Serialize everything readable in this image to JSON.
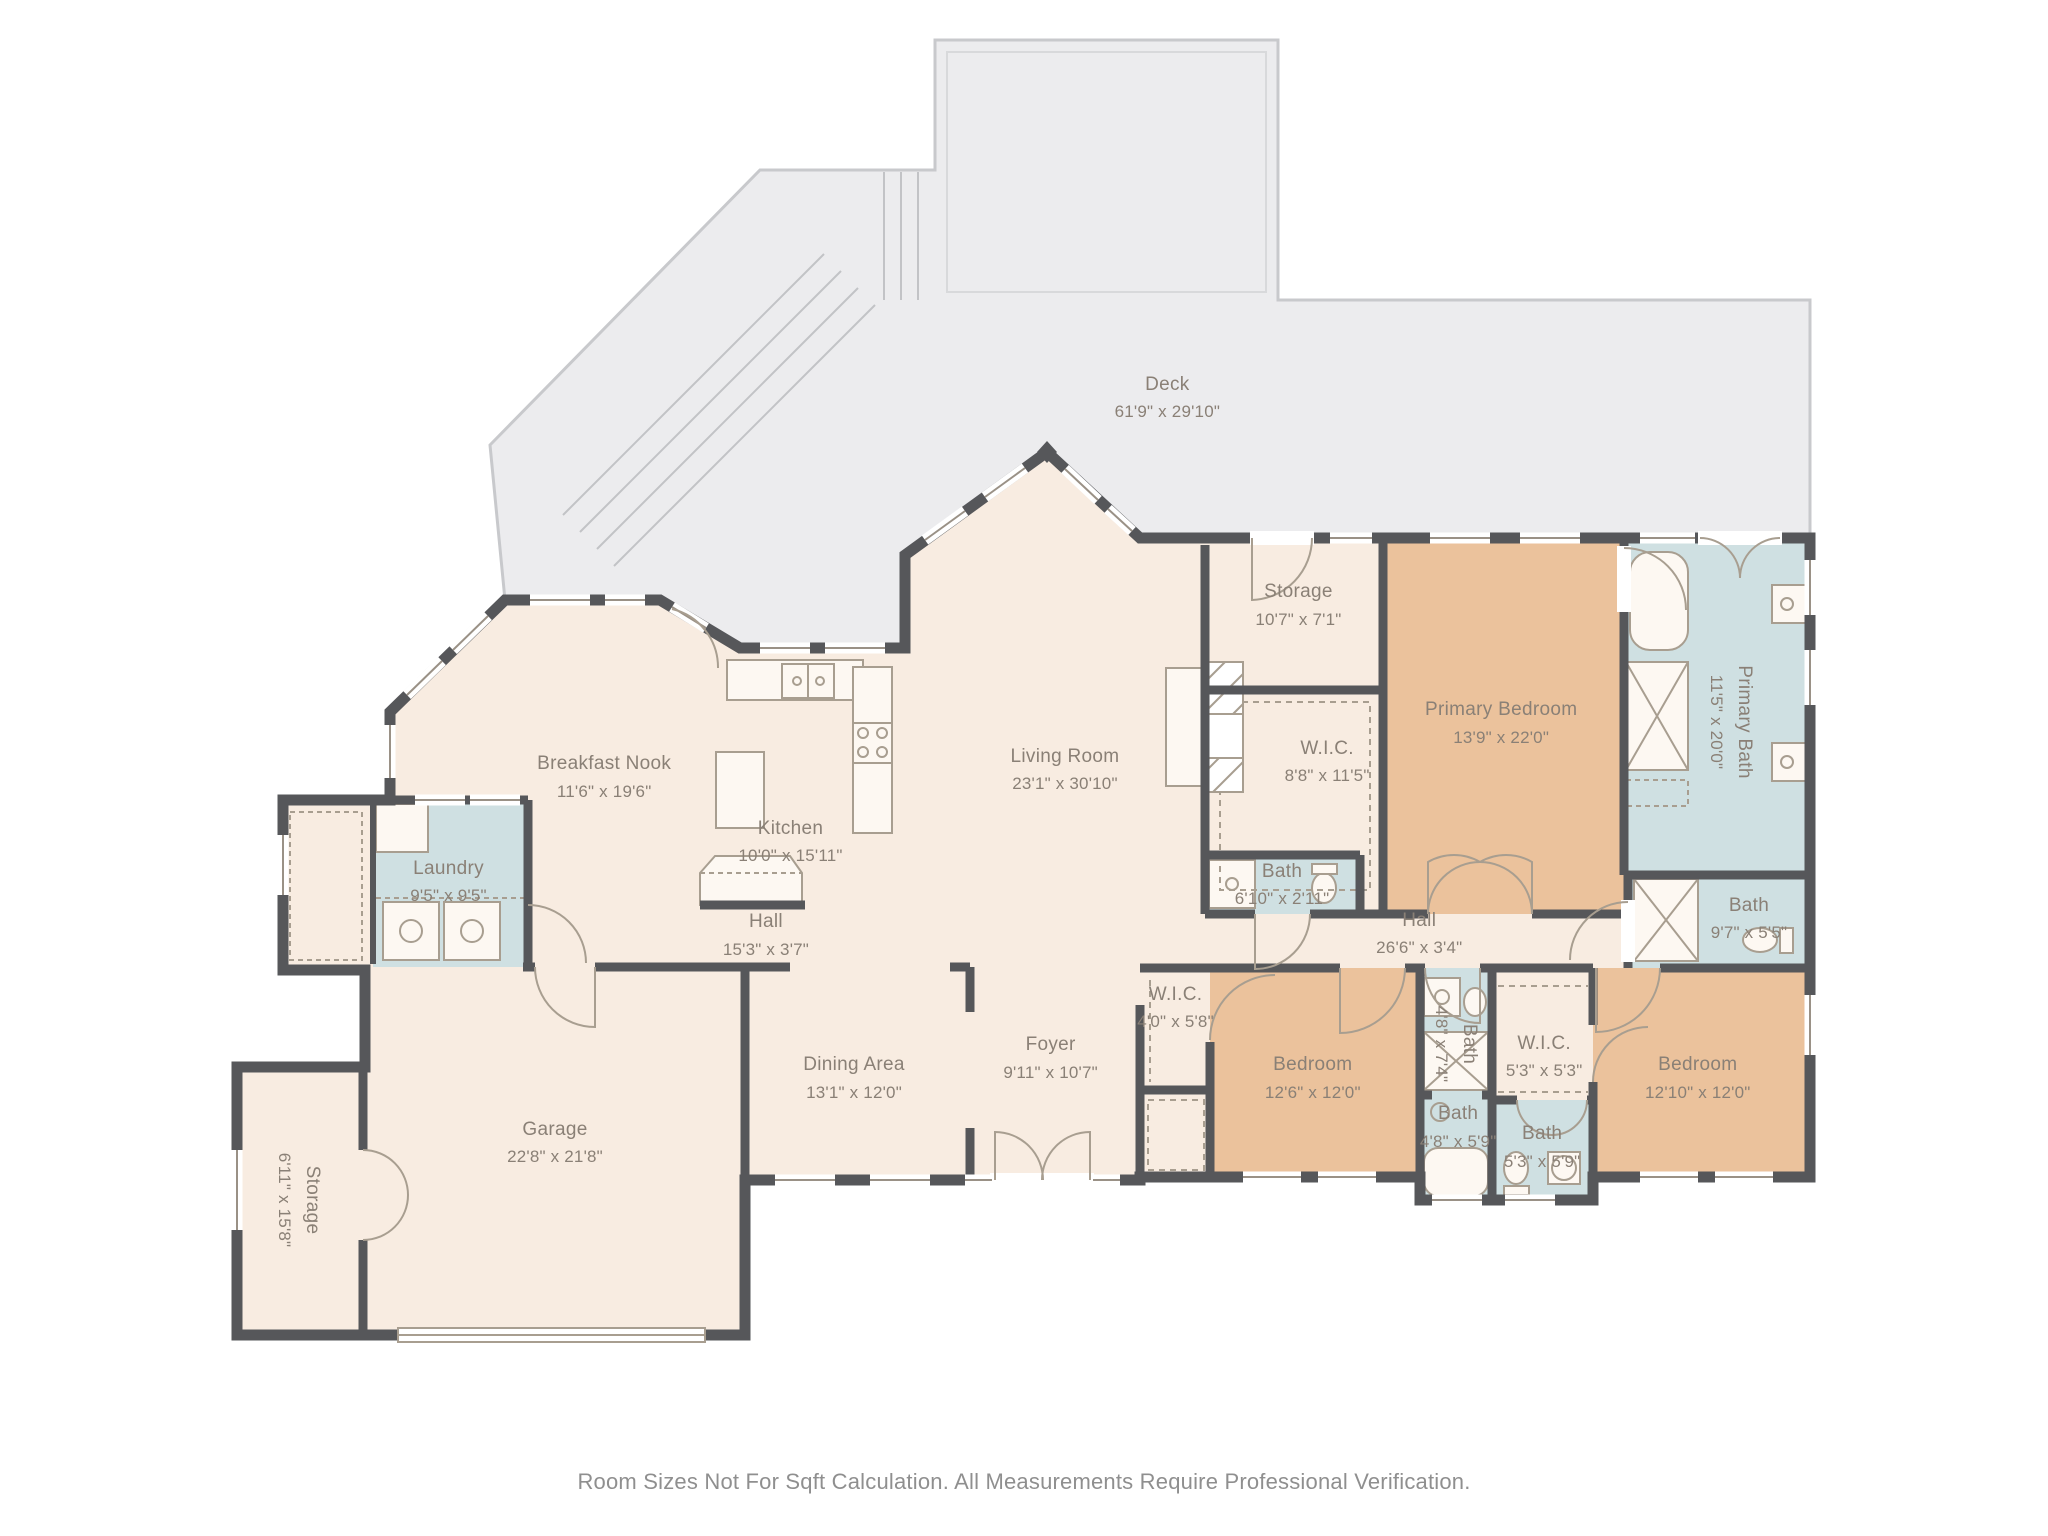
{
  "palette": {
    "floor": "#f8ece1",
    "bedroom_fill": "#ebc29c",
    "bath_fill": "#cfe0e2",
    "deck_fill": "#ececee",
    "deck_border": "#c8c9cc",
    "wall": "#56575a",
    "fixture_line": "#a89e90",
    "label_text": "#8a8076",
    "footer_text": "#8f8f8f"
  },
  "footer": {
    "disclaimer": "Room Sizes Not For Sqft Calculation. All Measurements Require Professional Verification."
  },
  "rooms": [
    {
      "id": "deck",
      "name": "Deck",
      "dims": "61'9\" x 29'10\"",
      "x": 57.0,
      "y": 25.9,
      "vert": false
    },
    {
      "id": "storage-top",
      "name": "Storage",
      "dims": "10'7\" x 7'1\"",
      "x": 63.4,
      "y": 39.4,
      "vert": false
    },
    {
      "id": "primary-bedroom",
      "name": "Primary Bedroom",
      "dims": "13'9\" x 22'0\"",
      "x": 73.3,
      "y": 47.1,
      "vert": false
    },
    {
      "id": "primary-bath",
      "name": "Primary Bath",
      "dims": "11'5\" x 20'0\"",
      "x": 84.5,
      "y": 47.0,
      "vert": true
    },
    {
      "id": "wic-primary",
      "name": "W.I.C.",
      "dims": "8'8\" x 11'5\"",
      "x": 64.8,
      "y": 49.6,
      "vert": false
    },
    {
      "id": "living-room",
      "name": "Living Room",
      "dims": "23'1\" x 30'10\"",
      "x": 52.0,
      "y": 50.1,
      "vert": false
    },
    {
      "id": "breakfast-nook",
      "name": "Breakfast Nook",
      "dims": "11'6\" x 19'6\"",
      "x": 29.5,
      "y": 50.6,
      "vert": false
    },
    {
      "id": "kitchen",
      "name": "Kitchen",
      "dims": "10'0\" x 15'11\"",
      "x": 38.6,
      "y": 54.8,
      "vert": false
    },
    {
      "id": "laundry",
      "name": "Laundry",
      "dims": "9'5\" x 9'5\"",
      "x": 21.9,
      "y": 57.4,
      "vert": false
    },
    {
      "id": "bath-610",
      "name": "Bath",
      "dims": "6'10\" x 2'11\"",
      "x": 62.6,
      "y": 57.6,
      "vert": false
    },
    {
      "id": "hall-west",
      "name": "Hall",
      "dims": "15'3\" x 3'7\"",
      "x": 37.4,
      "y": 60.9,
      "vert": false
    },
    {
      "id": "hall-east",
      "name": "Hall",
      "dims": "26'6\" x 3'4\"",
      "x": 69.3,
      "y": 60.8,
      "vert": false
    },
    {
      "id": "bath-97",
      "name": "Bath",
      "dims": "9'7\" x 5'5\"",
      "x": 85.4,
      "y": 59.8,
      "vert": false
    },
    {
      "id": "wic-40",
      "name": "W.I.C.",
      "dims": "4'0\" x 5'8\"",
      "x": 57.4,
      "y": 65.6,
      "vert": false
    },
    {
      "id": "bedroom-1",
      "name": "Bedroom",
      "dims": "12'6\" x 12'0\"",
      "x": 64.1,
      "y": 70.2,
      "vert": false
    },
    {
      "id": "bath-48a",
      "name": "Bath",
      "dims": "4'8\" x 7'4\"",
      "x": 71.1,
      "y": 68.0,
      "vert": true
    },
    {
      "id": "wic-53",
      "name": "W.I.C.",
      "dims": "5'3\" x 5'3\"",
      "x": 75.4,
      "y": 68.8,
      "vert": false
    },
    {
      "id": "bedroom-2",
      "name": "Bedroom",
      "dims": "12'10\" x 12'0\"",
      "x": 82.9,
      "y": 70.2,
      "vert": false
    },
    {
      "id": "bath-48b",
      "name": "Bath",
      "dims": "4'8\" x 5'9\"",
      "x": 71.2,
      "y": 73.4,
      "vert": false
    },
    {
      "id": "bath-53",
      "name": "Bath",
      "dims": "5'3\" x 5'9\"",
      "x": 75.3,
      "y": 74.7,
      "vert": false
    },
    {
      "id": "dining-area",
      "name": "Dining Area",
      "dims": "13'1\" x 12'0\"",
      "x": 41.7,
      "y": 70.2,
      "vert": false
    },
    {
      "id": "foyer",
      "name": "Foyer",
      "dims": "9'11\" x 10'7\"",
      "x": 51.3,
      "y": 68.9,
      "vert": false
    },
    {
      "id": "garage",
      "name": "Garage",
      "dims": "22'8\" x 21'8\"",
      "x": 27.1,
      "y": 74.4,
      "vert": false
    },
    {
      "id": "storage-annex",
      "name": "Storage",
      "dims": "6'11\" x 15'8\"",
      "x": 14.6,
      "y": 78.1,
      "vert": true
    }
  ]
}
